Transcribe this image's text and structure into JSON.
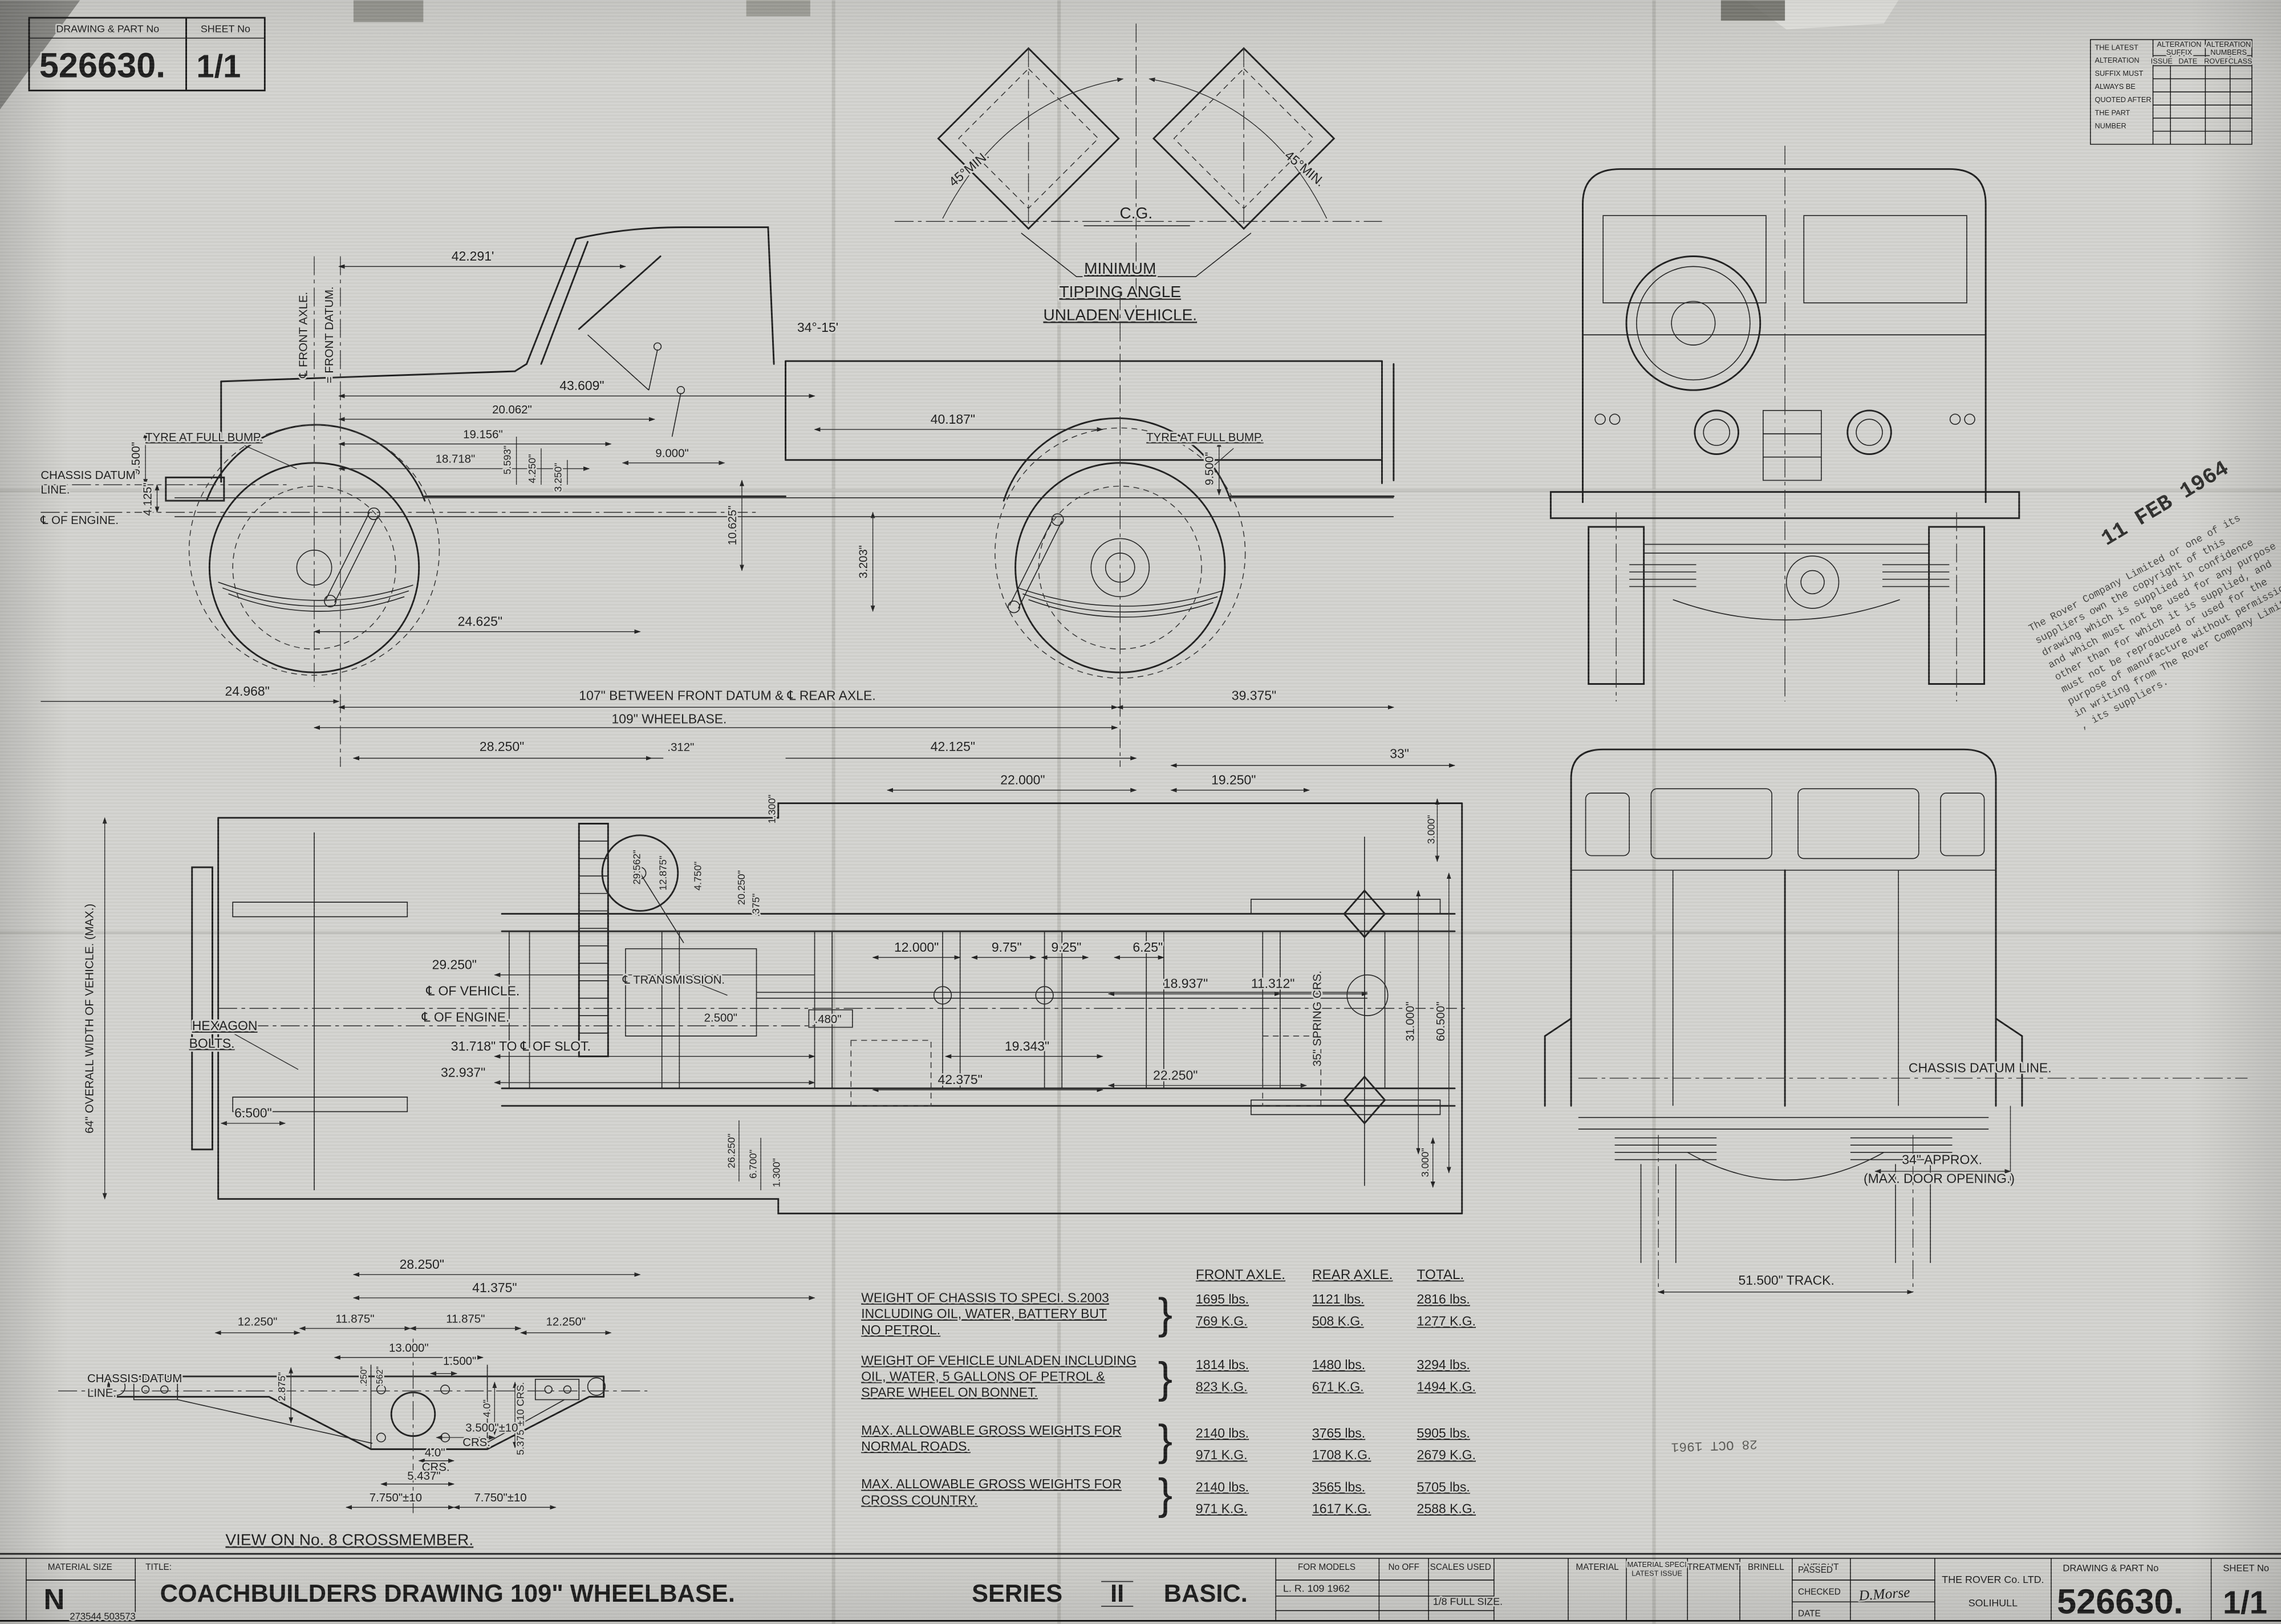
{
  "sheet": {
    "corner_box": {
      "part_label": "DRAWING & PART No",
      "sheet_label": "SHEET No",
      "part_no": "526630.",
      "sheet_no": "1/1"
    },
    "alteration_table": {
      "note_lines": [
        "THE LATEST",
        "ALTERATION",
        "SUFFIX MUST",
        "ALWAYS BE",
        "QUOTED AFTER",
        "THE PART",
        "NUMBER"
      ],
      "suffix_header": [
        "ALTERATION",
        "SUFFIX"
      ],
      "numbers_header": [
        "ALTERATION",
        "NUMBERS"
      ],
      "columns": [
        "ISSUE",
        "DATE",
        "ROVER",
        "CLASS"
      ]
    }
  },
  "tipping": {
    "cg": "C.G.",
    "left_angle": "45°MIN.",
    "right_angle": "45°MIN.",
    "caption": [
      "MINIMUM",
      "TIPPING ANGLE",
      "UNLADEN VEHICLE."
    ]
  },
  "side_view": {
    "front_axle_cl": "℄ FRONT AXLE.",
    "front_datum": "= FRONT DATUM.",
    "chassis_datum_1": "CHASSIS DATUM",
    "chassis_datum_2": "LINE.",
    "engine_cl": "℄ OF ENGINE.",
    "tyre_bump_front": "TYRE AT FULL BUMP.",
    "tyre_bump_rear": "TYRE AT FULL BUMP.",
    "screen_angle": "34°-15'",
    "dims_top": [
      "42.291'",
      "43.609\"",
      "20.062\"",
      "19.156\"",
      "18.718\"",
      "9.000\""
    ],
    "dims_vert": [
      "10.625\"",
      "3.203\"",
      "9.500\"",
      "4.125\"",
      "5.593\"",
      "4.250\"",
      "3.250\"",
      "9.500\""
    ],
    "dim_betw": "24.625\"",
    "dim_front_overhang": "24.968\"",
    "dim_datum_axle": "107\" BETWEEN FRONT DATUM & ℄ REAR AXLE.",
    "dim_rear_overhang": "39.375\"",
    "dim_wheelbase": "109\" WHEELBASE.",
    "dim_body_a": "28.250\"",
    "dim_body_b": ".312\"",
    "dim_bed": "40.187\""
  },
  "plan_view": {
    "dims_top": [
      "42.125\"",
      "33\"",
      "22.000\"",
      "19.250\"",
      "1.300\""
    ],
    "mid_dims": [
      "12.000\"",
      "9.75\"",
      "9.25\"",
      "6.25\"",
      "18.937\"",
      "11.312\"",
      "19.343\"",
      "42.375\"",
      "22.250\""
    ],
    "spring_crs": "35\" SPRING CRS.",
    "transmission_cl": "℄ TRANSMISSION.",
    "left_dims": [
      "29.250\"",
      "31.718\" TO ℄ OF SLOT.",
      "32.937\"",
      "6.500\""
    ],
    "vehicle_cl": "℄ OF VEHICLE.",
    "engine_cl": "℄ OF ENGINE.",
    "hexagon_bolts_1": "HEXAGON",
    "hexagon_bolts_2": "BOLTS.",
    "small_dims": [
      "2.500\"",
      ".480\"",
      ".375\"",
      "4.750\"",
      "12.875\"",
      "29.562\"",
      "20.250\""
    ],
    "right_dims": [
      "3.000\"",
      "31.000\"",
      "60.500\"",
      "3.000\""
    ],
    "bottom_vert_dims": [
      "26.250\"",
      "6.700\"",
      "1.300\""
    ],
    "bottom_dims": [
      "28.250\"",
      "41.375\""
    ],
    "overall_width": "64\" OVERALL WIDTH OF VEHICLE. (MAX.)"
  },
  "rear_view": {
    "chassis_datum": "CHASSIS DATUM LINE.",
    "door_opening_1": "34\" APPROX.",
    "door_opening_2": "(MAX. DOOR OPENING.)",
    "track": "51.500\" TRACK."
  },
  "crossmember_view": {
    "chassis_datum_1": "CHASSIS DATUM",
    "chassis_datum_2": "LINE.",
    "dims_top": [
      "12.250\"",
      "11.875\"",
      "11.875\"",
      "12.250\"",
      "13.000\"",
      "1.500\""
    ],
    "dims_vert": [
      "2.875\"",
      ".250\"",
      ".562\"",
      "4.0\"",
      "5.375\"±10 CRS."
    ],
    "dims_bottom": [
      "3.500\"±10",
      "CRS.",
      "4.0\"",
      "CRS.",
      "5.437\"",
      "7.750\"±10",
      "7.750\"±10"
    ],
    "caption": "VIEW ON No. 8 CROSSMEMBER."
  },
  "weight_table": {
    "col_headers": [
      "FRONT AXLE.",
      "REAR AXLE.",
      "TOTAL."
    ],
    "rows": [
      {
        "desc": [
          "WEIGHT OF CHASSIS TO SPECI. S.2003",
          "INCLUDING OIL, WATER,  BATTERY BUT",
          "NO PETROL."
        ],
        "front_lbs": "1695 lbs.",
        "front_kg": "769  K.G.",
        "rear_lbs": "1121 lbs.",
        "rear_kg": "508 K.G.",
        "total_lbs": "2816 lbs.",
        "total_kg": "1277 K.G."
      },
      {
        "desc": [
          "WEIGHT OF VEHICLE UNLADEN INCLUDING",
          "OIL, WATER, 5 GALLONS OF PETROL &",
          "SPARE WHEEL ON BONNET."
        ],
        "front_lbs": "1814  lbs.",
        "front_kg": "823  K.G.",
        "rear_lbs": "1480 lbs.",
        "rear_kg": "671  K.G.",
        "total_lbs": "3294 lbs.",
        "total_kg": "1494  K.G."
      },
      {
        "desc": [
          "MAX. ALLOWABLE GROSS WEIGHTS FOR",
          "NORMAL ROADS."
        ],
        "front_lbs": "2140 lbs.",
        "front_kg": "971  K.G.",
        "rear_lbs": "3765 lbs.",
        "rear_kg": "1708 K.G.",
        "total_lbs": "5905 lbs.",
        "total_kg": "2679 K.G."
      },
      {
        "desc": [
          "MAX. ALLOWABLE GROSS WEIGHTS FOR",
          "CROSS COUNTRY."
        ],
        "front_lbs": "2140 lbs.",
        "front_kg": "971  K.G.",
        "rear_lbs": "3565 lbs.",
        "rear_kg": "1617 K.G.",
        "total_lbs": "5705 lbs.",
        "total_kg": "2588 K.G."
      }
    ]
  },
  "stamps": {
    "copyright_lines": [
      "The Rover Company Limited or one of its",
      "suppliers own  the  copyright  of  this",
      "drawing which is supplied in confidence",
      "and which must not be used for any purpose",
      "other than for which it is supplied, and",
      "must not be reproduced  or  used for the",
      "purpose of manufacture without permission",
      "in writing from The Rover Company Limited",
      ", its suppliers."
    ],
    "date_stamp_1": "11 FEB 1964",
    "date_stamp_2": "28 OCT 1961"
  },
  "title_block": {
    "material_size_label": "MATERIAL SIZE",
    "material_size_value": "N",
    "ref_numbers": "273544      503573",
    "title_label": "TITLE:",
    "title_main": "COACHBUILDERS  DRAWING  109\"  WHEELBASE.",
    "series_word": "SERIES",
    "series_numeral": "II",
    "series_suffix": "BASIC.",
    "for_models_label": "FOR MODELS",
    "for_models_value": "L. R. 109     1962",
    "no_off_label": "No OFF",
    "scales_label": "SCALES  USED",
    "scales_value": "1/8 FULL SIZE.",
    "material_label": "MATERIAL",
    "material_spec_label_1": "MATERIAL SPECI",
    "material_spec_label_2": "LATEST ISSUE",
    "treatment_label": "TREATMENT",
    "brinell_label": "BRINELL",
    "weight_label": "WEIGHT",
    "passed_label": "PASSED",
    "checked_label": "CHECKED",
    "date_label": "DATE",
    "checked_signature": "D.Morse",
    "company_name": "THE ROVER Co. LTD.",
    "company_city": "SOLIHULL",
    "part_label": "DRAWING & PART No",
    "part_no": "526630.",
    "sheet_label": "SHEET No",
    "sheet_no": "1/1"
  }
}
